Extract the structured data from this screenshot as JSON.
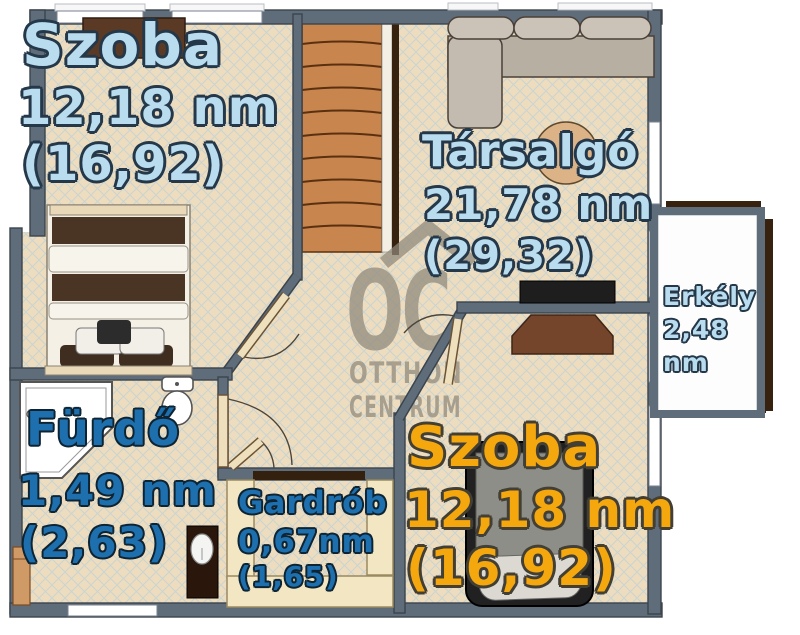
{
  "watermark": {
    "logo": "OC",
    "line1": "OTTHON",
    "line2": "CENTRUM"
  },
  "rooms": {
    "bedroom_top_left": {
      "name": "Szoba",
      "area": "12,18 nm",
      "gross": "(16,92)"
    },
    "lounge": {
      "name": "Társalgó",
      "area": "21,78 nm",
      "gross": "(29,32)"
    },
    "balcony": {
      "name": "Erkély",
      "area": "2,48",
      "unit": "nm"
    },
    "bathroom": {
      "name": "Fürdő",
      "area": "1,49 nm",
      "gross": "(2,63)"
    },
    "wardrobe": {
      "name": "Gardrób",
      "area": "0,67nm",
      "gross": "(1,65)"
    },
    "bedroom_bottom_right": {
      "name": "Szoba",
      "area": "12,18 nm",
      "gross": "(16,92)"
    }
  },
  "colors": {
    "floor": "#eedcbe",
    "hatch": "#b5d0dd",
    "wall": "#5f6d7a",
    "wall_outline": "#3b444d",
    "stairs": "#c8854e",
    "stair_line": "#5a3010",
    "railing": "#37220f",
    "balcony_floor": "#fdfdfd",
    "label_light_blue": "#b9dcef",
    "label_dark_blue": "#1e6fae",
    "label_amber": "#f5a80e",
    "watermark": "#8f887b",
    "furniture_dark": "#4a3423",
    "closet_cream": "#f3e7c3",
    "sofa": "#c4bbb0",
    "table": "#dcb387"
  }
}
